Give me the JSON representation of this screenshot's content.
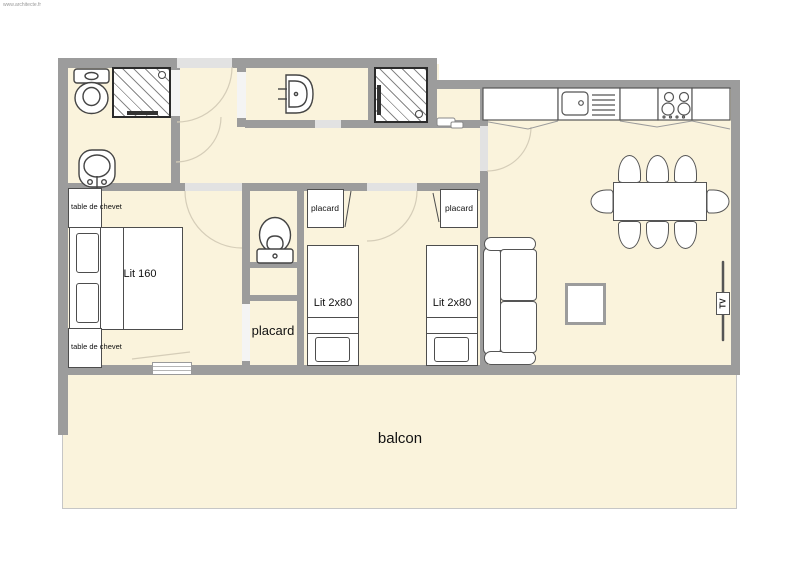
{
  "watermark": "www.architecte.fr",
  "colors": {
    "wall": "#9c9c9c",
    "floor": "#faf3dc",
    "furniture_outline": "#4d4d4d",
    "door_arc": "#d5cdb8",
    "shower_hatch": "#888888",
    "background": "#ffffff"
  },
  "labels": {
    "master_bed": "Lit 160",
    "nightstand_top": "table de chevet",
    "nightstand_bottom": "table de chevet",
    "kids_bed_left": "Lit 2x80",
    "kids_bed_right": "Lit 2x80",
    "kids_closet_left": "placard",
    "kids_closet_right": "placard",
    "hall_closet": "placard",
    "balcony": "balcon",
    "tv": "TV"
  }
}
